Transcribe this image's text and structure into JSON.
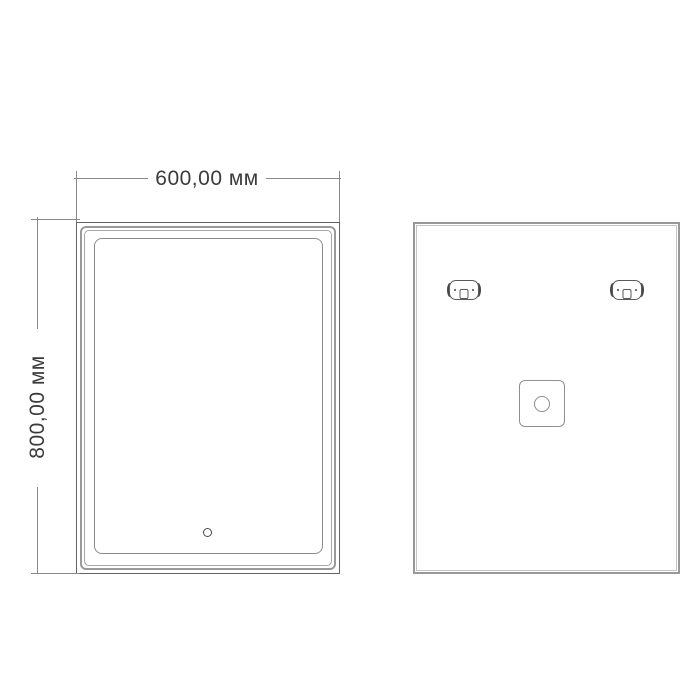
{
  "annotations": {
    "width_dimension": "600,00 мм",
    "height_dimension": "800,00 мм"
  },
  "views": {
    "front": {
      "features": [
        "outer-edge",
        "illuminated-frame",
        "led-strip-line",
        "touch-sensor"
      ]
    },
    "back": {
      "features": [
        "back-panel",
        "mounting-bracket-left",
        "mounting-bracket-right",
        "junction-box"
      ]
    }
  },
  "colors": {
    "background": "#ffffff",
    "drawing_line": "#646464",
    "frame_gray": "#9a9a9a",
    "dimension_line": "#8a8a8a",
    "text": "#3b3b3b",
    "bracket_dark": "#474747"
  }
}
